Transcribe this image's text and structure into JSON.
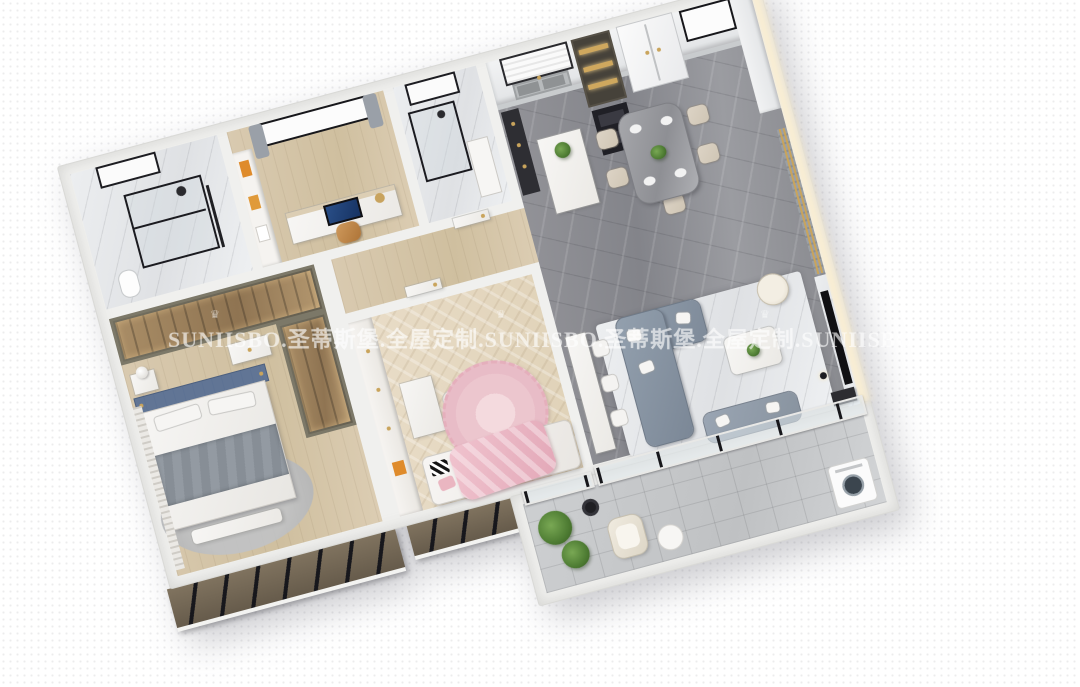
{
  "watermark": {
    "text": "SUNIISBO.圣蒂斯堡.全屋定制.SUNIISBO.圣蒂斯堡.全屋定制.SUNIISBO",
    "crown": "♛",
    "color": "#ffffff",
    "opacity": "0.52"
  },
  "scene": {
    "view": "axonometric-3d-floorplan-render",
    "rooms": [
      {
        "name": "entry-bathroom",
        "furniture": [
          "glass-shower",
          "toilet",
          "window",
          "marble-tiles"
        ]
      },
      {
        "name": "study",
        "furniture": [
          "bookshelf",
          "desk",
          "computer-monitor",
          "office-chair",
          "window-with-curtains"
        ]
      },
      {
        "name": "second-bathroom",
        "furniture": [
          "glass-shower",
          "vanity",
          "window"
        ]
      },
      {
        "name": "kitchen",
        "furniture": [
          "upper-cabinets",
          "window-blind",
          "double-sink",
          "display-cabinet",
          "oven-stack",
          "fridge",
          "island",
          "bar-cabinet"
        ]
      },
      {
        "name": "dining-area",
        "furniture": [
          "marble-dining-table",
          "cream-chairs",
          "plates",
          "centerpiece-plant"
        ]
      },
      {
        "name": "living-room",
        "furniture": [
          "l-shaped-sofa",
          "loveseat",
          "coffee-table",
          "console-table",
          "stools",
          "accent-chair",
          "tv-wall",
          "tv",
          "area-rug",
          "floor-lamp",
          "media-cabinet"
        ]
      },
      {
        "name": "master-bedroom",
        "furniture": [
          "walk-in-wardrobe",
          "dresser",
          "nightstand",
          "lamp",
          "double-bed",
          "blue-headboard",
          "gray-throw",
          "bench",
          "round-rug",
          "window-blinds"
        ]
      },
      {
        "name": "kids-bedroom",
        "furniture": [
          "bookcase-wall",
          "desk",
          "chair",
          "pink-round-rug",
          "bed",
          "pink-duvet",
          "zigzag-pillows"
        ]
      },
      {
        "name": "hallway",
        "furniture": [
          "doors"
        ]
      },
      {
        "name": "balcony",
        "furniture": [
          "plants",
          "side-table",
          "lounge-chair",
          "round-table",
          "washing-machine",
          "sliding-glass-doors"
        ]
      }
    ]
  },
  "palette": {
    "background": "#ffffff",
    "wall": "#f0f0ee",
    "marble_floor_gray": "#8a8b90",
    "marble_light": "#e8e9eb",
    "wood_floor": "#d5c5a8",
    "herringbone_floor": "#e6dac6",
    "balcony_tile": "#c8cacb",
    "sofa_gray": "#8b97a6",
    "headboard_blue": "#5d7294",
    "kids_pink": "#eab9c4",
    "wardrobe_olive": "#6e6a5c",
    "exterior_taupe": "#74685a",
    "accent_gold": "#c9a45c",
    "plant_green": "#55843c",
    "tv_black": "#121214"
  }
}
